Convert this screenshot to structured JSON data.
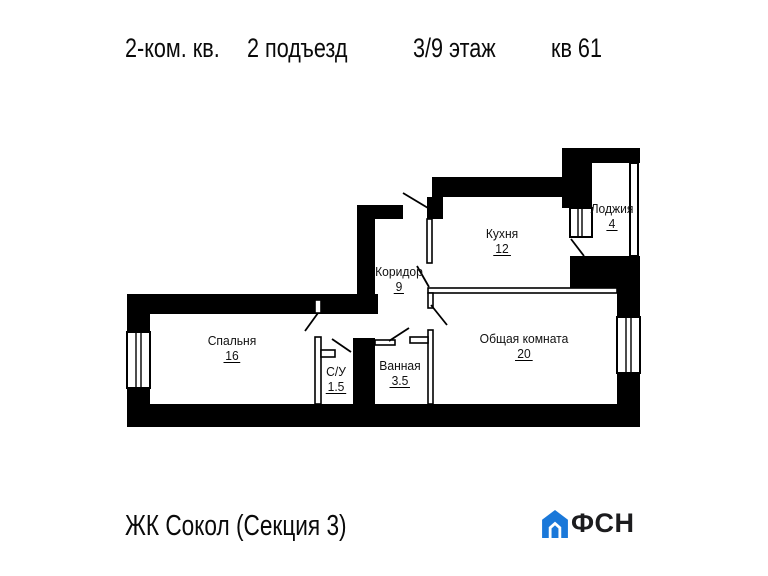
{
  "header": {
    "apartment_type": "2-ком. кв.",
    "entrance": "2 подъезд",
    "floor": "3/9 этаж",
    "unit": "кв 61"
  },
  "plan": {
    "rooms": [
      {
        "name": "Кухня",
        "area": "12"
      },
      {
        "name": "Лоджия",
        "area": "4"
      },
      {
        "name": "Коридор",
        "area": "9"
      },
      {
        "name": "Спальня",
        "area": "16"
      },
      {
        "name": "С/У",
        "area": "1.5"
      },
      {
        "name": "Ванная",
        "area": "3.5"
      },
      {
        "name": "Общая комната",
        "area": "20"
      }
    ]
  },
  "footer": {
    "project": "ЖК Сокол (Секция 3)",
    "brand": "ФСН"
  },
  "colors": {
    "wall": "#000000",
    "brand_blue": "#1a78d9",
    "brand_text": "#1c1c1e"
  }
}
